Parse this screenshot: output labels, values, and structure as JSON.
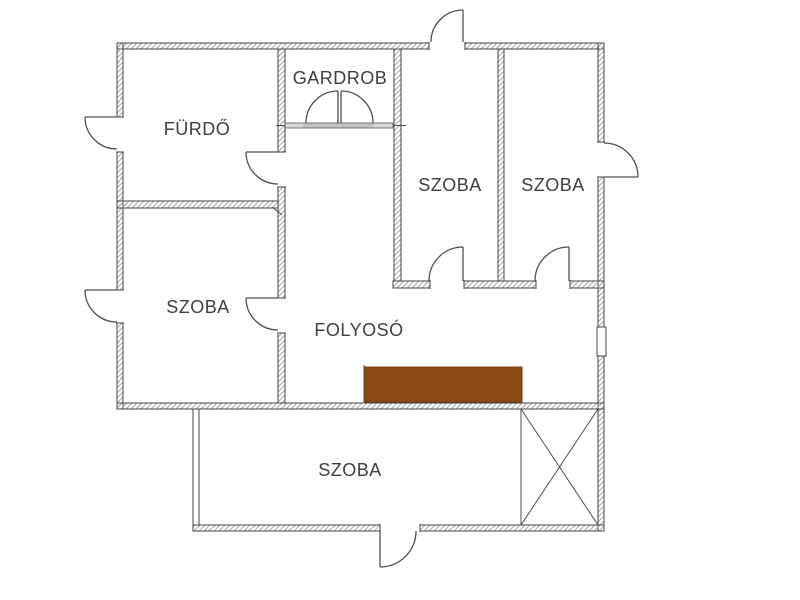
{
  "rooms": {
    "furdo": {
      "label": "FÜRDŐ"
    },
    "gardrob": {
      "label": "GARDROB"
    },
    "szoba_top_left": {
      "label": "SZOBA"
    },
    "szoba_top_right": {
      "label": "SZOBA"
    },
    "szoba_mid_left": {
      "label": "SZOBA"
    },
    "folyoso": {
      "label": "FOLYOSÓ"
    },
    "szoba_bottom": {
      "label": "SZOBA"
    }
  },
  "colors": {
    "background": "#ffffff",
    "wall_outline": "#454545",
    "wall_hatch": "#a8a8a8",
    "door_line": "#4f4f4f",
    "label_text": "#3f3f3f",
    "stairs_fill": "#8a4a12",
    "stairs_border": "#7a3d0a",
    "threshold_fill": "#d8d8d8",
    "threshold_shade": "#c2c2c2"
  }
}
